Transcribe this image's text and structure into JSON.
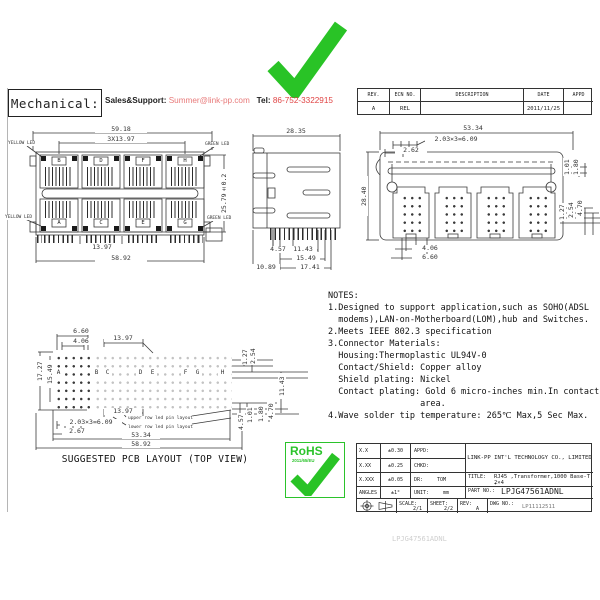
{
  "header": {
    "mechanical_label": "Mechanical:",
    "sales_label": "Sales&Support:",
    "email": "Summer@link-pp.com",
    "tel_label": "Tel:",
    "tel_number": "86-752-3322915",
    "rev_table": {
      "headers": [
        "REV.",
        "ECN NO.",
        "DESCRIPTION",
        "DATE",
        "APPD"
      ],
      "row": {
        "rev": "A",
        "ecn": "REL",
        "description": "",
        "date": "2011/11/25",
        "appd": ""
      }
    }
  },
  "front_view": {
    "ports_top": [
      "B",
      "D",
      "F",
      "H"
    ],
    "ports_bottom": [
      "A",
      "C",
      "E",
      "G"
    ],
    "led_labels": {
      "yellow": "YELLOW LED",
      "green": "GREEN LED"
    },
    "dims": {
      "overall_width": "59.18",
      "port_pitch_total": "3X13.97",
      "height": "25.79±0.2",
      "port_pitch": "13.97",
      "body_width": "58.92"
    }
  },
  "side_view": {
    "dims": {
      "depth": "28.35",
      "pin1": "4.57",
      "pin2": "11.43",
      "pin3": "15.49",
      "pin4": "17.41",
      "body": "10.89"
    }
  },
  "bottom_view": {
    "dims": {
      "width": "53.34",
      "pin_pitch": "2.03×3=6.09",
      "edge": "2.62",
      "depth": "28.40",
      "r1": "1.01",
      "r2": "1.80",
      "r3": "1.27",
      "r4": "2.54",
      "r5": "4.70",
      "post_a": "4.06",
      "post_b": "6.60"
    }
  },
  "notes": {
    "lines": [
      "NOTES:",
      "1.Designed to support application,such as SOHO(ADSL",
      "  modems),LAN-on-Motherboard(LOM),hub and Switches.",
      "2.Meets IEEE 802.3 specification",
      "3.Connector Materials:",
      "  Housing:Thermoplastic UL94V-0",
      "  Contact/Shield: Copper alloy",
      "  Shield plating: Nickel",
      "  Contact plating: Gold 6 micro-inches min.In contact",
      "                  area.",
      "4.Wave solder tip temperature: 265℃ Max,5 Sec Max."
    ]
  },
  "pcb_layout": {
    "letters": [
      "A",
      "B",
      "C",
      "D",
      "E",
      "F",
      "G",
      "H"
    ],
    "dims": {
      "d1": "6.60",
      "d2": "4.06",
      "d3": "13.97",
      "left1": "17.27",
      "left2": "15.49",
      "r1": "1.27",
      "r2": "2.54",
      "r3": "11.43",
      "b1": "2.03×3=6.09",
      "b2": "2.67",
      "b3": "13.97",
      "b4": "53.34",
      "b5": "58.92",
      "br1": "4.57",
      "br2": "1.01",
      "br3": "1.80",
      "br4": "4.70"
    },
    "leader_upper": "upper row led pin layout",
    "leader_lower": "lower row led pin layout",
    "caption": "SUGGESTED PCB LAYOUT (TOP VIEW)"
  },
  "rohs": {
    "label": "RoHS",
    "directive": "2011/65/EU"
  },
  "title_block": {
    "tol_rows": [
      {
        "label": "X.X",
        "value": "±0.30"
      },
      {
        "label": "X.XX",
        "value": "±0.25"
      },
      {
        "label": "X.XXX",
        "value": "±0.05"
      },
      {
        "label": "ANGLES",
        "value": "±1°"
      }
    ],
    "appd_label": "APPD:",
    "chkd_label": "CHKD:",
    "dr_label": "DR:",
    "dr_value": "TOM",
    "unit_label": "UNIT:",
    "unit_value": "mm",
    "company": "LINK-PP INT'L TECHNOLOGY CO., LIMITED",
    "title_label": "TITLE:",
    "title_line1": "RJ45 ,Transformer,1000 Base-T ,",
    "title_line2": "2×4",
    "part_label": "PART NO.:",
    "part_no": "LPJG47561ADNL",
    "scale_label": "SCALE:",
    "scale": "2/1",
    "sheet_label": "SHEET:",
    "sheet": "2/2",
    "rev_label": "REV:",
    "rev": "A",
    "dwg_label": "DWG NO.:",
    "dwg_no": "LP11112511"
  },
  "footer_code": "LPJG47561ADNL",
  "colors": {
    "accent_red": "#e04343",
    "link_red": "#e87a7a",
    "green": "#2bc32b",
    "line": "#3a3a3a"
  }
}
